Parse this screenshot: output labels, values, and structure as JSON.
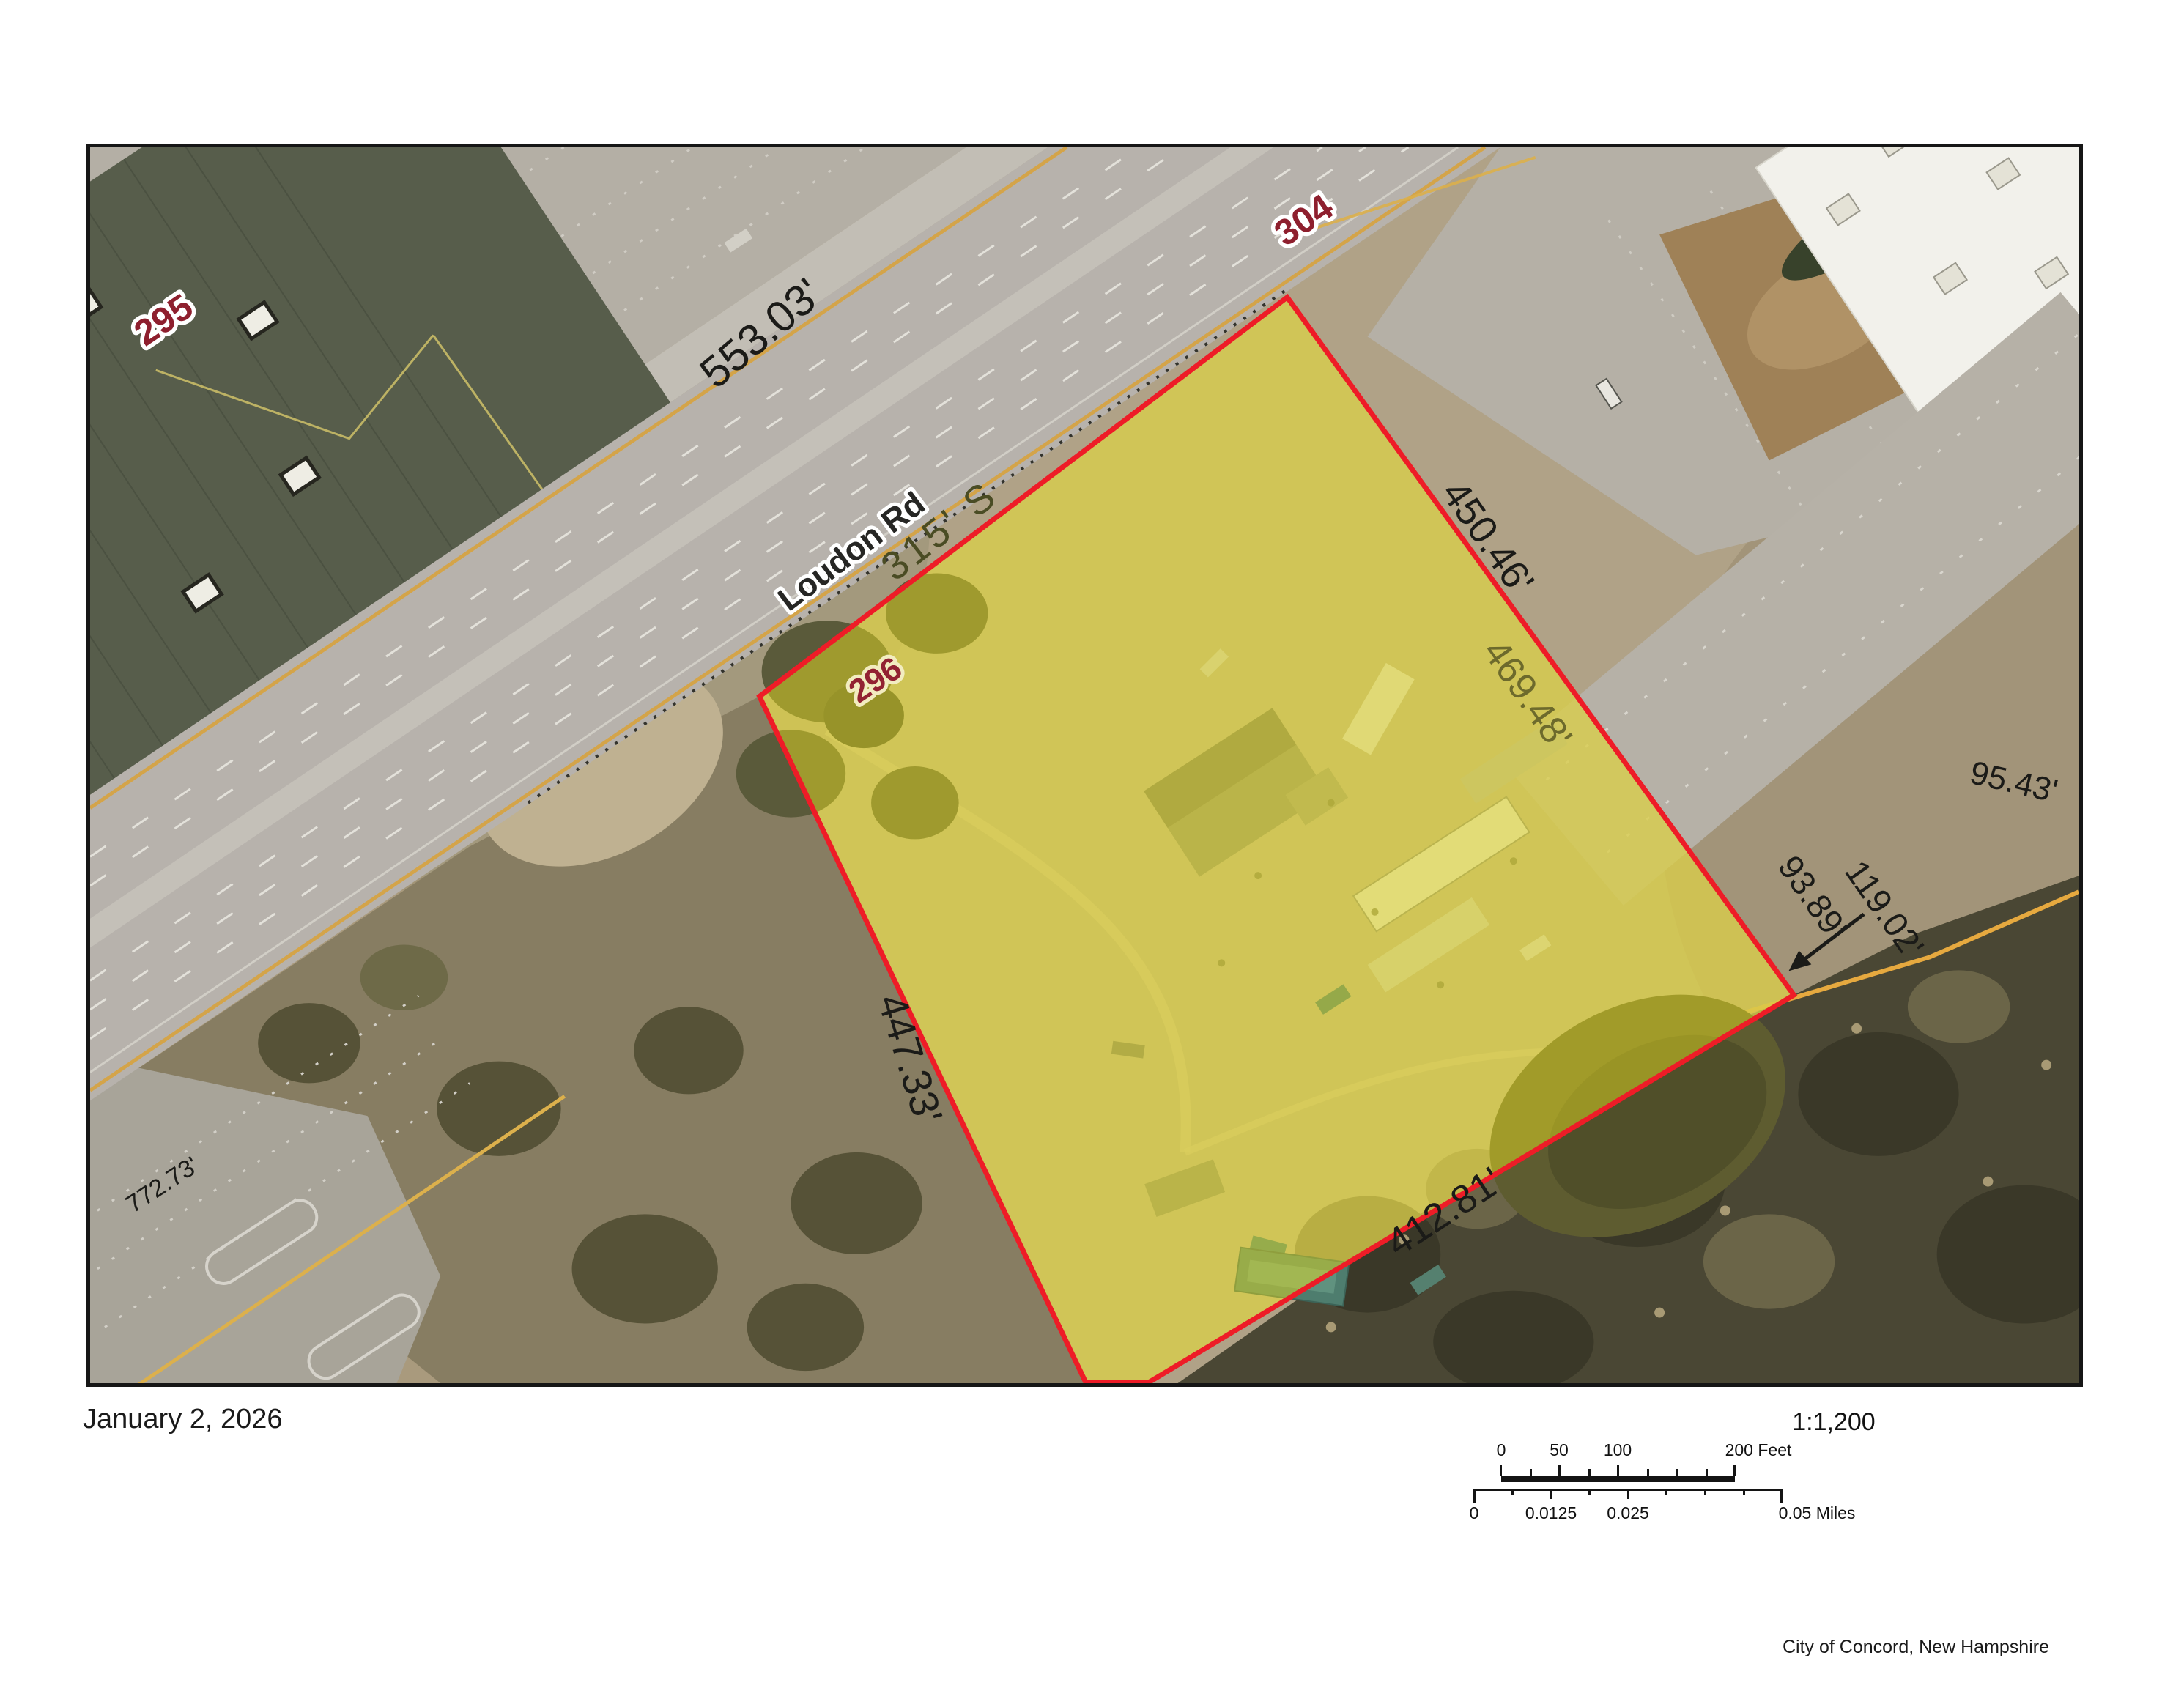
{
  "page": {
    "date": "January 2, 2026",
    "attribution": "City of Concord, New Hampshire"
  },
  "map": {
    "road": {
      "name": "Loudon Rd"
    },
    "parcels": {
      "left": "295",
      "subject": "296",
      "top": "304"
    },
    "dims": {
      "road_front": "553.03'",
      "south_315": "315' S",
      "ne_outer": "450.46'",
      "ne_inner": "469.48'",
      "east_top": "95.43'",
      "east_mid": "93.89'",
      "east_leader": "119.02'",
      "west": "447.33'",
      "southeast": "412.81'",
      "sw_road": "772.73'"
    },
    "colors": {
      "parcel_outline": "#ee1c27",
      "parcel_fill": "rgba(235,224,33,0.48)",
      "id_label": "#8e1f2e"
    }
  },
  "scalebar": {
    "ratio": "1:1,200",
    "feet": {
      "t0": "0",
      "t50": "50",
      "t100": "100",
      "t200": "200 Feet"
    },
    "miles": {
      "t0": "0",
      "t1": "0.0125",
      "t2": "0.025",
      "t3": "0.05 Miles"
    }
  }
}
